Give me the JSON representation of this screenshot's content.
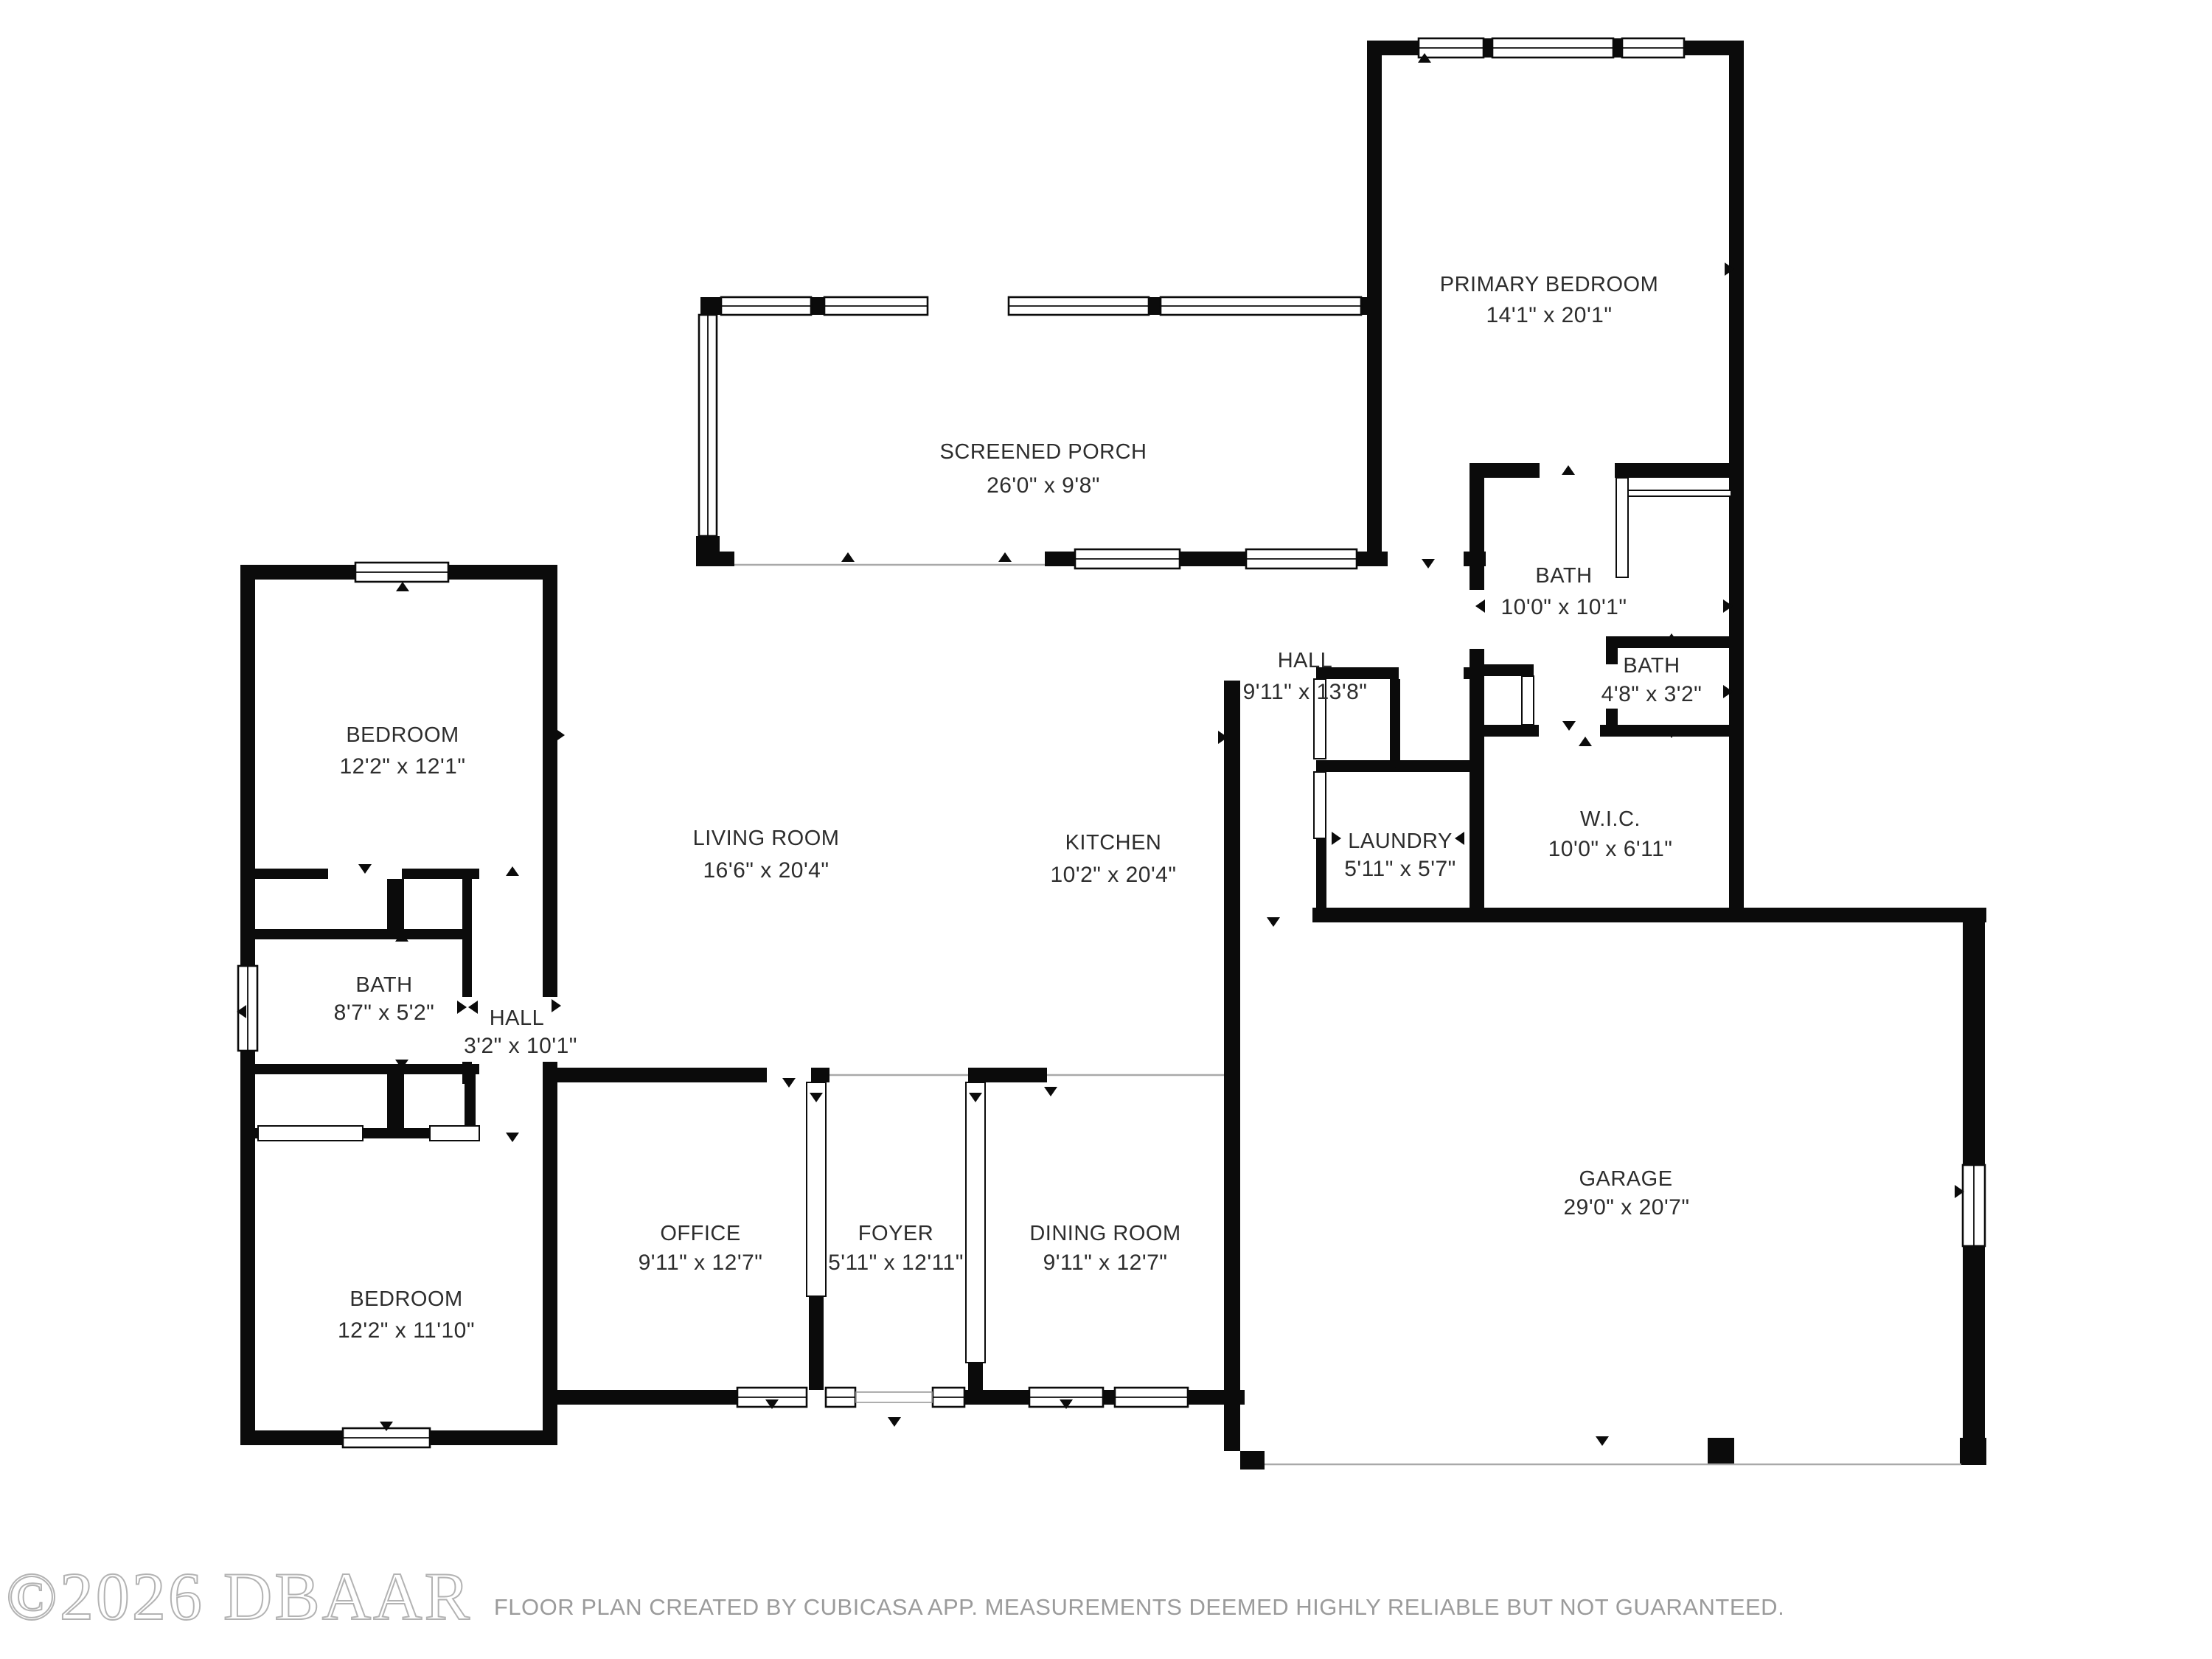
{
  "watermark": {
    "text": "©2026 DBAAR"
  },
  "footer": {
    "disclaimer": "FLOOR PLAN CREATED BY CUBICASA APP. MEASUREMENTS DEEMED HIGHLY RELIABLE BUT NOT GUARANTEED."
  },
  "rooms": [
    {
      "id": "primary-bedroom",
      "name": "PRIMARY BEDROOM",
      "dims": "14'1\" x 20'1\""
    },
    {
      "id": "screened-porch",
      "name": "SCREENED PORCH",
      "dims": "26'0\" x 9'8\""
    },
    {
      "id": "bath-primary",
      "name": "BATH",
      "dims": "10'0\" x 10'1\""
    },
    {
      "id": "hall-right",
      "name": "HALL",
      "dims": "9'11\" x 13'8\""
    },
    {
      "id": "bath-toilet",
      "name": "BATH",
      "dims": "4'8\" x 3'2\""
    },
    {
      "id": "wic",
      "name": "W.I.C.",
      "dims": "10'0\" x 6'11\""
    },
    {
      "id": "laundry",
      "name": "LAUNDRY",
      "dims": "5'11\" x 5'7\""
    },
    {
      "id": "living-room",
      "name": "LIVING ROOM",
      "dims": "16'6\" x 20'4\""
    },
    {
      "id": "kitchen",
      "name": "KITCHEN",
      "dims": "10'2\" x 20'4\""
    },
    {
      "id": "bedroom-upper",
      "name": "BEDROOM",
      "dims": "12'2\" x 12'1\""
    },
    {
      "id": "bath-hall",
      "name": "BATH",
      "dims": "8'7\" x 5'2\""
    },
    {
      "id": "hall-left",
      "name": "HALL",
      "dims": "3'2\" x 10'1\""
    },
    {
      "id": "bedroom-lower",
      "name": "BEDROOM",
      "dims": "12'2\" x 11'10\""
    },
    {
      "id": "office",
      "name": "OFFICE",
      "dims": "9'11\" x 12'7\""
    },
    {
      "id": "foyer",
      "name": "FOYER",
      "dims": "5'11\" x 12'11\""
    },
    {
      "id": "dining-room",
      "name": "DINING ROOM",
      "dims": "9'11\" x 12'7\""
    },
    {
      "id": "garage",
      "name": "GARAGE",
      "dims": "29'0\" x 20'7\""
    }
  ]
}
